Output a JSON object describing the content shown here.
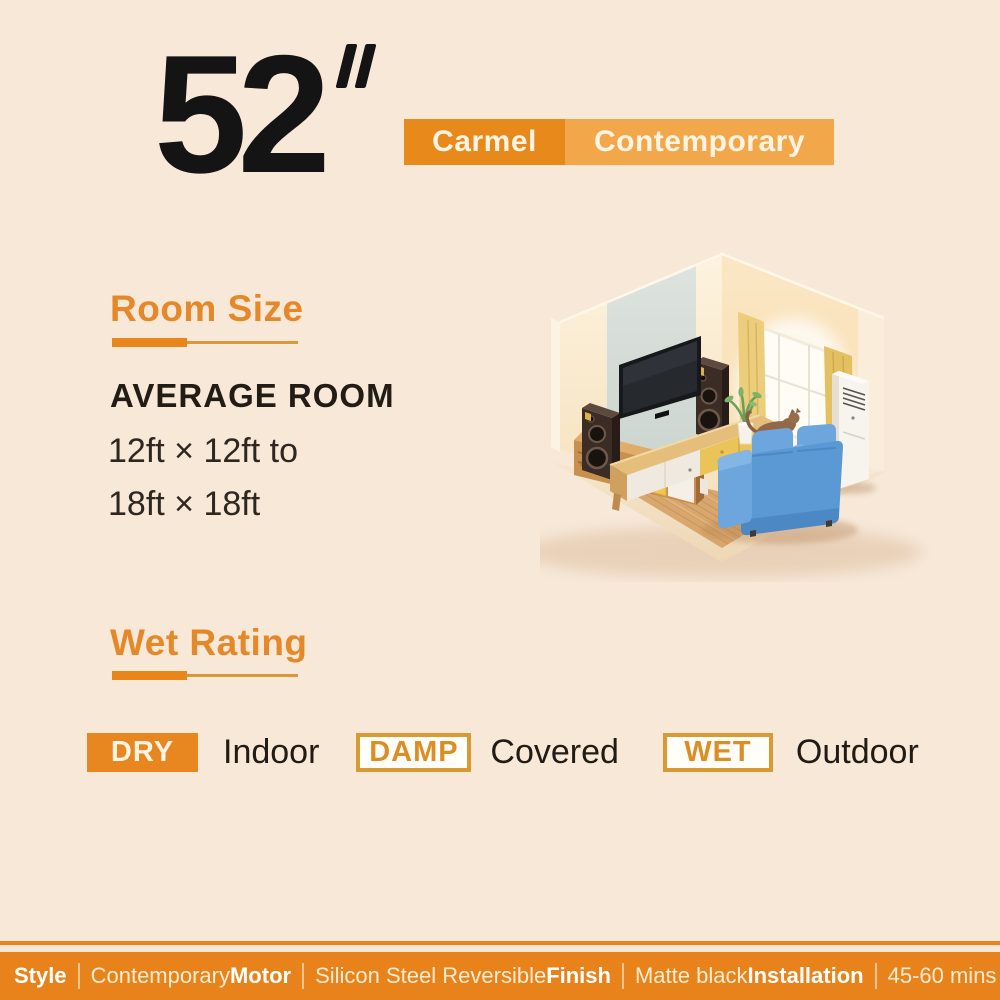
{
  "colors": {
    "background": "#F7E8D8",
    "accent_orange": "#E8871F",
    "accent_orange_light": "#F3A74B",
    "bar_orange": "#E8831C",
    "text_dark": "#1B1B1B"
  },
  "header": {
    "size_value": "52",
    "size_unit_icon": "double-prime",
    "badge": {
      "name": "Carmel",
      "collection": "Contemporary"
    }
  },
  "room_size": {
    "heading": "Room Size",
    "subheading": "AVERAGE ROOM",
    "line1": "12ft × 12ft to",
    "line2": "18ft × 18ft"
  },
  "illustration": {
    "alt": "Isometric living room with wall TV, speakers, media console, blue sofa, cat, coffee table, plant, curtained window and floor air conditioner on a wood floor"
  },
  "wet_rating": {
    "heading": "Wet Rating",
    "items": [
      {
        "badge": "DRY",
        "label": "Indoor",
        "style": "filled"
      },
      {
        "badge": "DAMP",
        "label": "Covered",
        "style": "outlined"
      },
      {
        "badge": "WET",
        "label": "Outdoor",
        "style": "outlined"
      }
    ]
  },
  "footer": {
    "specs": [
      {
        "label": "Style",
        "value": "Contemporary"
      },
      {
        "label": "Motor",
        "value": "Silicon Steel Reversible"
      },
      {
        "label": "Finish",
        "value": "Matte black"
      },
      {
        "label": "Installation",
        "value": "45-60 mins"
      }
    ]
  }
}
